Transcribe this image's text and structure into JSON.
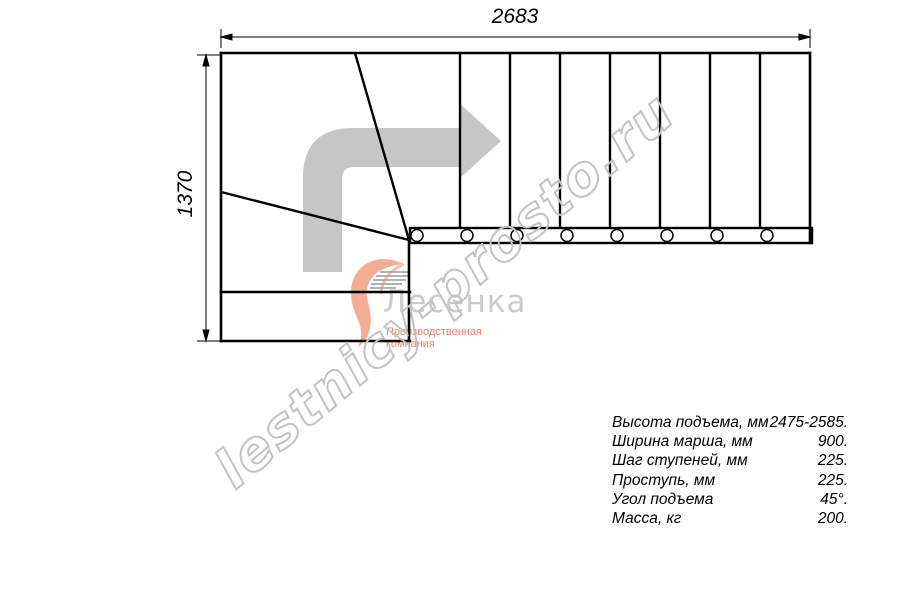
{
  "plan": {
    "type": "staircase-top-view",
    "straight_treads": 8,
    "winder_treads": 3,
    "baluster_count": 8,
    "turn_direction": "up-from-bottom-then-right",
    "colors": {
      "line": "#000000",
      "direction_arrow": "#c6c6c6",
      "watermark_outline": "#c3c3c3",
      "logo_text": "#cbcbcb",
      "logo_accent": "#e98568"
    }
  },
  "dimensions": {
    "width_mm": "2683",
    "height_mm": "1370"
  },
  "watermark": {
    "text": "lestnicy-prosto.ru"
  },
  "logo": {
    "name": "Лесенка",
    "tagline": "Производственная компания"
  },
  "specs": {
    "rows": [
      {
        "label": "Высота подъема, мм",
        "value": "2475-2585."
      },
      {
        "label": "Ширина марша, мм",
        "value": "900."
      },
      {
        "label": "Шаг ступеней, мм",
        "value": "225."
      },
      {
        "label": "Проступь, мм",
        "value": "225."
      },
      {
        "label": "Угол подъема",
        "value": "45°."
      },
      {
        "label": "Масса, кг",
        "value": "200."
      }
    ]
  }
}
